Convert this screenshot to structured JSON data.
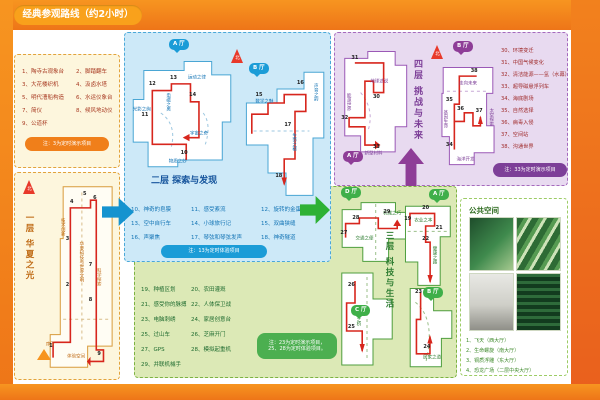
{
  "header": {
    "title": "经典参观路线（约2小时）"
  },
  "colors": {
    "frame": "#f0841c",
    "floor1_accent": "#f07f1a",
    "floor2_accent": "#1b9cd7",
    "floor3_accent": "#4caf50",
    "floor4_accent": "#8e3d97",
    "route": "#d7261d"
  },
  "floor1": {
    "map_title": "一层 华夏之光",
    "compass": "北",
    "items": [
      "1、陶寺古观象台",
      "2、脚踏翻车",
      "3、大花楼织机",
      "4、汲卤水塔",
      "5、明代漕船构造",
      "6、水运仪象台",
      "7、简仪",
      "8、候风地动仪",
      "9、公道杯"
    ],
    "note": "注：3为定时演示项目",
    "zones": [
      {
        "t": "技术创新",
        "x": 26,
        "y": 24,
        "v": 1
      },
      {
        "t": "华夏科技与世界文明",
        "x": 52,
        "y": 42,
        "v": 1
      },
      {
        "t": "科学探索",
        "x": 76,
        "y": 50,
        "v": 1
      },
      {
        "t": "序厅",
        "x": 10,
        "y": 86
      },
      {
        "t": "体验空间",
        "x": 46,
        "y": 92
      }
    ],
    "points": [
      {
        "n": "1",
        "x": 11,
        "y": 86
      },
      {
        "n": "2",
        "x": 34,
        "y": 54
      },
      {
        "n": "3",
        "x": 34,
        "y": 30
      },
      {
        "n": "4",
        "x": 40,
        "y": 11
      },
      {
        "n": "5",
        "x": 58,
        "y": 7
      },
      {
        "n": "6",
        "x": 72,
        "y": 9
      },
      {
        "n": "7",
        "x": 66,
        "y": 44
      },
      {
        "n": "8",
        "x": 66,
        "y": 62
      },
      {
        "n": "9",
        "x": 78,
        "y": 90
      }
    ]
  },
  "floor2": {
    "title": "二层 探索与发现",
    "halls": [
      "A 厅",
      "B 厅"
    ],
    "compass": "北",
    "items": [
      "10、神奇的皂膜",
      "11、感受紊流",
      "12、旋转的金蛋",
      "13、空中自行车",
      "14、小球旅行记",
      "15、双曲狭缝",
      "16、声聚焦",
      "17、琴弦和琴弦发声",
      "18、神奇隧道"
    ],
    "note": "注：13为定时体验项目",
    "zonesL": [
      {
        "t": "光影之绚",
        "x": 12,
        "y": 48
      },
      {
        "t": "电磁之奥",
        "x": 36,
        "y": 40,
        "v": 1
      },
      {
        "t": "运动之律",
        "x": 64,
        "y": 20
      },
      {
        "t": "宇宙之奇",
        "x": 66,
        "y": 70
      },
      {
        "t": "物质之妙",
        "x": 46,
        "y": 95
      }
    ],
    "pointsL": [
      {
        "n": "10",
        "x": 52,
        "y": 86
      },
      {
        "n": "11",
        "x": 15,
        "y": 52
      },
      {
        "n": "12",
        "x": 22,
        "y": 24
      },
      {
        "n": "13",
        "x": 42,
        "y": 19
      },
      {
        "n": "14",
        "x": 60,
        "y": 34
      }
    ],
    "zonesR": [
      {
        "t": "数学之魅",
        "x": 26,
        "y": 30
      },
      {
        "t": "声音之韵",
        "x": 82,
        "y": 22,
        "v": 1
      },
      {
        "t": "生命之秘",
        "x": 58,
        "y": 58,
        "v": 1
      }
    ],
    "pointsR": [
      {
        "n": "15",
        "x": 20,
        "y": 24
      },
      {
        "n": "16",
        "x": 66,
        "y": 16
      },
      {
        "n": "17",
        "x": 52,
        "y": 46
      },
      {
        "n": "18",
        "x": 42,
        "y": 82
      }
    ]
  },
  "floor3": {
    "title": "三层 科技与生活",
    "halls": [
      "A 厅",
      "B 厅",
      "C 厅",
      "D 厅"
    ],
    "items": [
      "19、种植区划",
      "20、农田灌溉",
      "21、感受你的脉搏",
      "22、人体保卫战",
      "23、电脑刺绣",
      "24、家居创意台",
      "25、过山车",
      "26、芝麻开门",
      "27、GPS",
      "28、模拟起重机",
      "29、并联机械手"
    ],
    "note1": "注：23为定时演示项目，",
    "note2": "25、28为定时体验项目。",
    "zonesD": [
      {
        "t": "交通之便",
        "x": 32,
        "y": 62
      },
      {
        "t": "机械之巧",
        "x": 64,
        "y": 26
      }
    ],
    "pointsD": [
      {
        "n": "27",
        "x": 8,
        "y": 52
      },
      {
        "n": "28",
        "x": 22,
        "y": 30
      },
      {
        "n": "29",
        "x": 58,
        "y": 22
      }
    ],
    "zonesA": [
      {
        "t": "农业之本",
        "x": 40,
        "y": 26
      },
      {
        "t": "健康之路",
        "x": 58,
        "y": 62,
        "v": 1
      }
    ],
    "pointsA": [
      {
        "n": "19",
        "x": 12,
        "y": 22
      },
      {
        "n": "20",
        "x": 44,
        "y": 10
      },
      {
        "n": "21",
        "x": 68,
        "y": 32
      },
      {
        "n": "22",
        "x": 44,
        "y": 44
      }
    ],
    "zonesC": [
      {
        "t": "信息之桥",
        "x": 34,
        "y": 48,
        "v": 1
      }
    ],
    "pointsC": [
      {
        "n": "26",
        "x": 24,
        "y": 16
      },
      {
        "n": "25",
        "x": 24,
        "y": 58
      }
    ],
    "zonesB": [
      {
        "t": "居家之道",
        "x": 52,
        "y": 86
      }
    ],
    "pointsB": [
      {
        "n": "23",
        "x": 26,
        "y": 8
      },
      {
        "n": "24",
        "x": 42,
        "y": 72
      }
    ]
  },
  "floor4": {
    "title": "四层 挑战与未来",
    "halls": [
      "A 厅",
      "B 厅"
    ],
    "compass": "北",
    "items": [
      "30、环境变迁",
      "31、中国气候变化",
      "32、清洁能源——氢（水幕）",
      "33、超导磁悬浮列车",
      "34、海底剧场",
      "35、自然选择",
      "36、病毒入侵",
      "37、空间站",
      "38、沟通世界"
    ],
    "note": "注：33为定时演示项目",
    "zonesL": [
      {
        "t": "能源世界",
        "x": 12,
        "y": 48,
        "v": 1
      },
      {
        "t": "地球述说",
        "x": 56,
        "y": 32
      },
      {
        "t": "新型材料",
        "x": 48,
        "y": 95
      }
    ],
    "pointsL": [
      {
        "n": "31",
        "x": 22,
        "y": 10
      },
      {
        "n": "30",
        "x": 52,
        "y": 44
      },
      {
        "n": "32",
        "x": 8,
        "y": 62
      },
      {
        "n": "33",
        "x": 52,
        "y": 88
      }
    ],
    "zonesR": [
      {
        "t": "走向未来",
        "x": 50,
        "y": 22
      },
      {
        "t": "基因生命",
        "x": 12,
        "y": 54,
        "v": 1
      },
      {
        "t": "太空探索",
        "x": 86,
        "y": 52,
        "v": 1
      },
      {
        "t": "海洋开发",
        "x": 46,
        "y": 93
      }
    ],
    "pointsR": [
      {
        "n": "38",
        "x": 60,
        "y": 9
      },
      {
        "n": "35",
        "x": 20,
        "y": 36
      },
      {
        "n": "36",
        "x": 38,
        "y": 44
      },
      {
        "n": "37",
        "x": 68,
        "y": 46
      },
      {
        "n": "34",
        "x": 20,
        "y": 78
      }
    ]
  },
  "public_space": {
    "title": "公共空间",
    "captions": [
      "1、飞天（西大厅）",
      "2、生命螺旋（南大厅）",
      "3、铜质浮雕（东大厅）",
      "4、恐龙广场（二层中央大厅）"
    ]
  }
}
